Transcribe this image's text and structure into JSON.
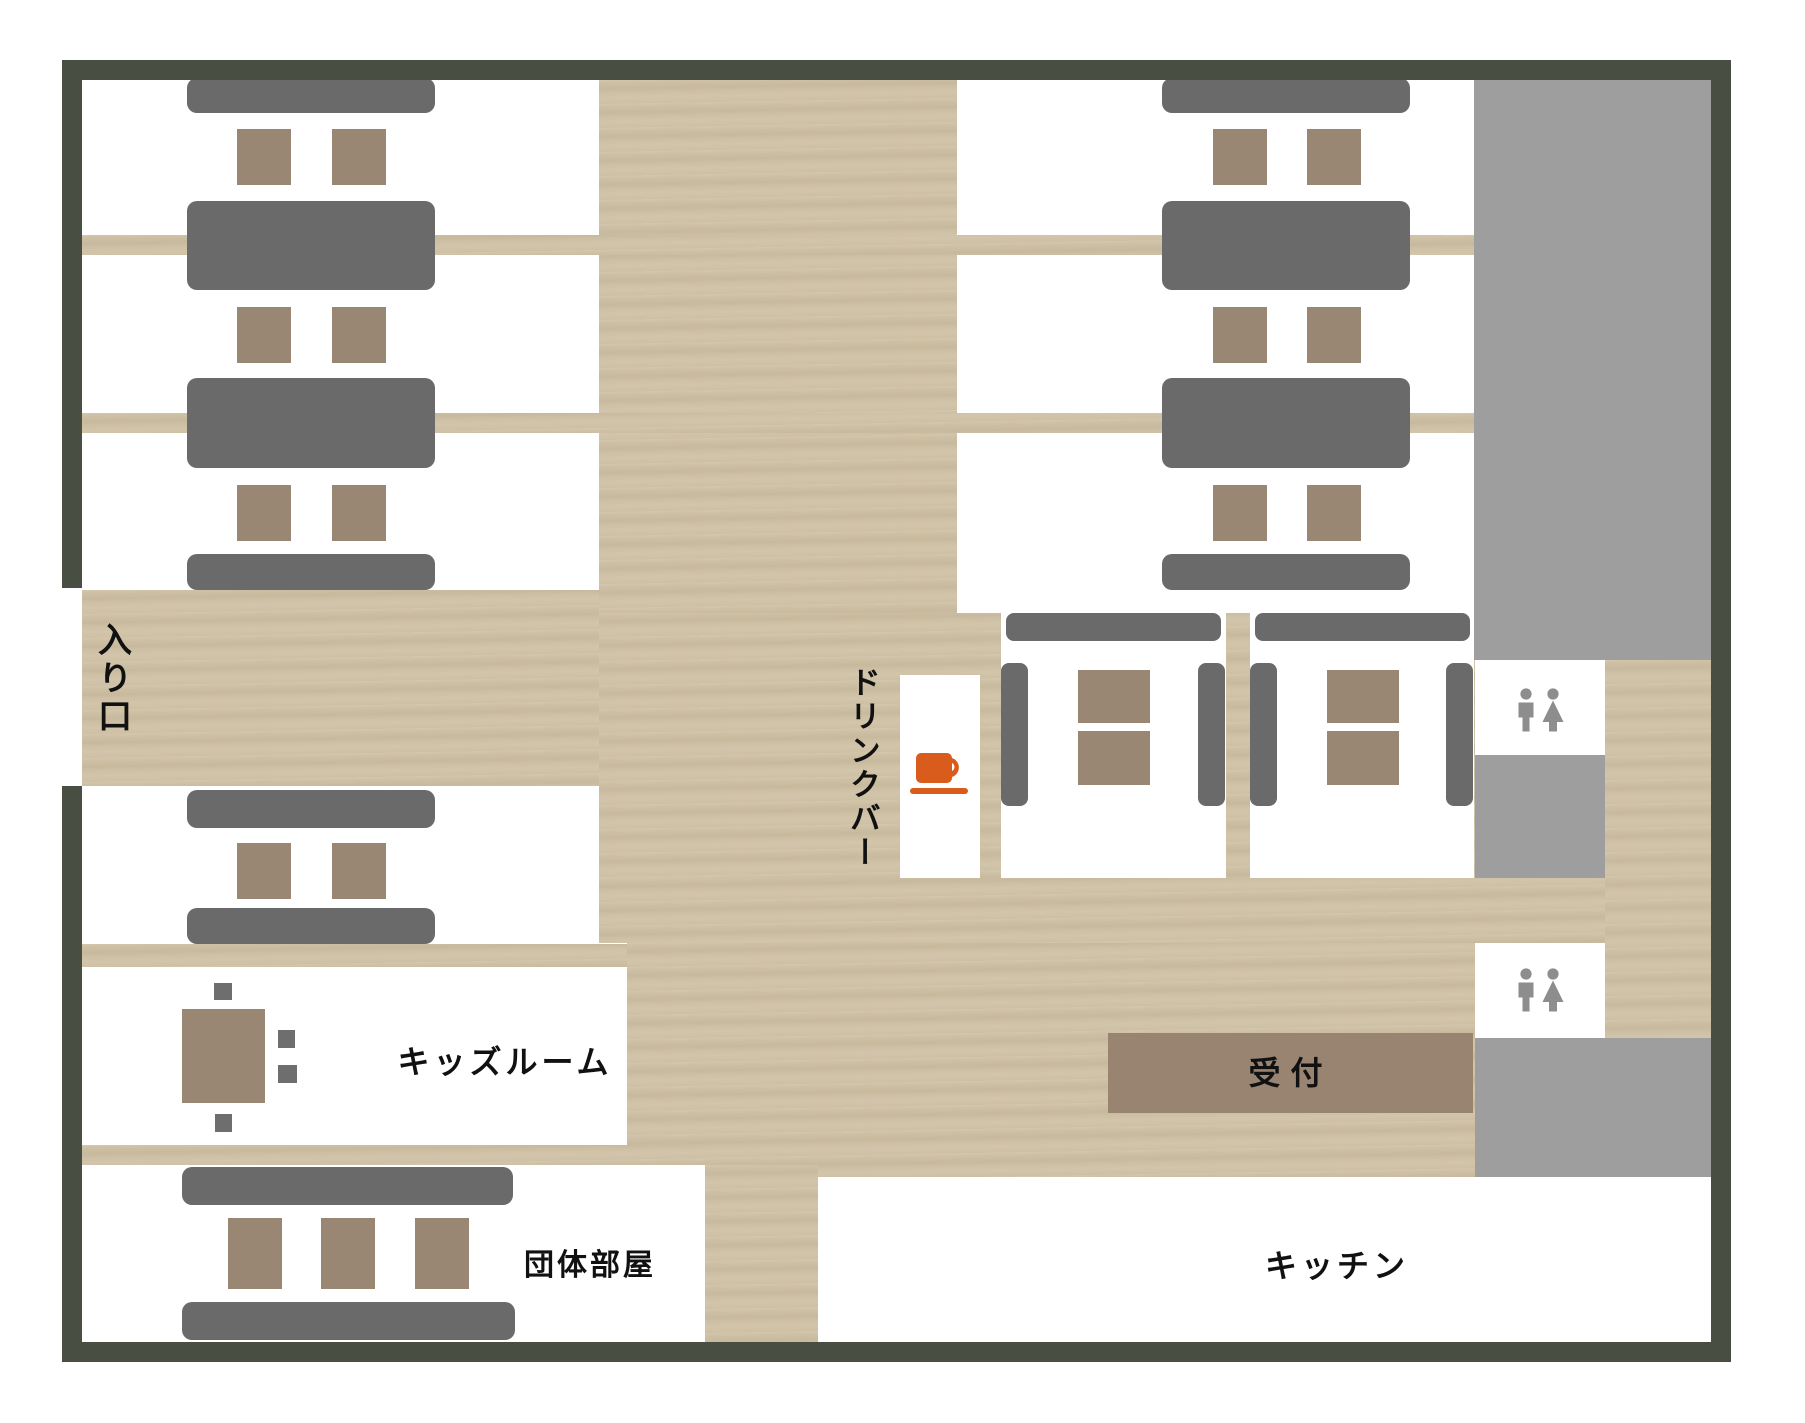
{
  "plan": {
    "labels": {
      "entrance": "入り口",
      "drink_bar": "ドリンクバー",
      "kids_room": "キッズルーム",
      "group_room": "団体部屋",
      "reception": "受付",
      "kitchen": "キッチン"
    },
    "icons": {
      "drink_bar": "coffee-cup",
      "restroom_upper": "male-female-restroom",
      "restroom_lower": "male-female-restroom"
    },
    "colors": {
      "wall": "#494e42",
      "wood_floor": "#cec0a4",
      "bench": "#6a6a6a",
      "stool": "#9a8773",
      "gray_zone": "#9e9e9e",
      "reception_desk": "#998471",
      "cup_orange": "#da5c1d",
      "restroom_icon": "#8d8d8d",
      "label_text": "#111111"
    }
  }
}
